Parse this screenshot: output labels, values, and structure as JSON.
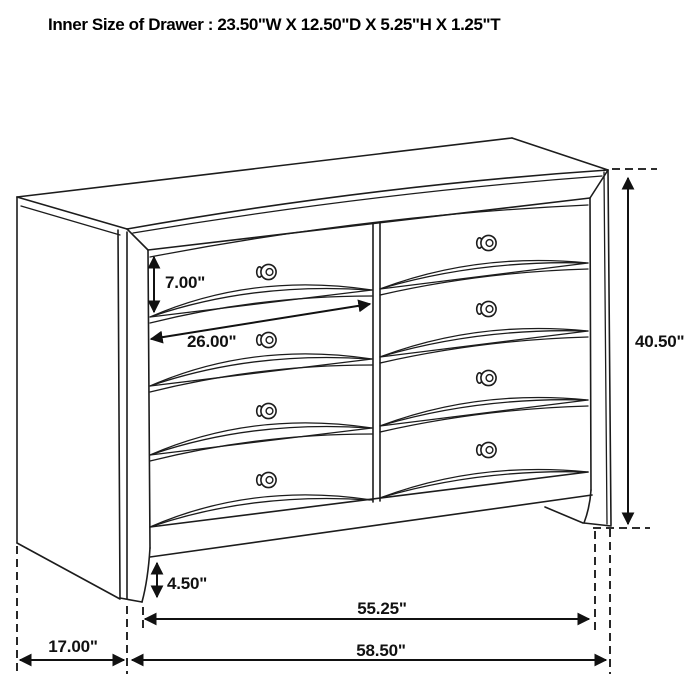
{
  "title": "Inner Size of Drawer : 23.50\"W X 12.50\"D X 5.25\"H X 1.25\"T",
  "figure": {
    "type": "dresser-line-drawing",
    "drawer_rows": 4,
    "drawer_columns": 2,
    "knob_count": 8
  },
  "dimensions": {
    "drawer_face_height": "7.00\"",
    "drawer_front_width": "26.00\"",
    "overall_height": "40.50\"",
    "base_clearance": "4.50\"",
    "front_width_inner": "55.25\"",
    "side_depth": "17.00\"",
    "overall_width": "58.50\""
  },
  "colors": {
    "background": "#ffffff",
    "line": "#1c1c1c",
    "text": "#111111"
  }
}
